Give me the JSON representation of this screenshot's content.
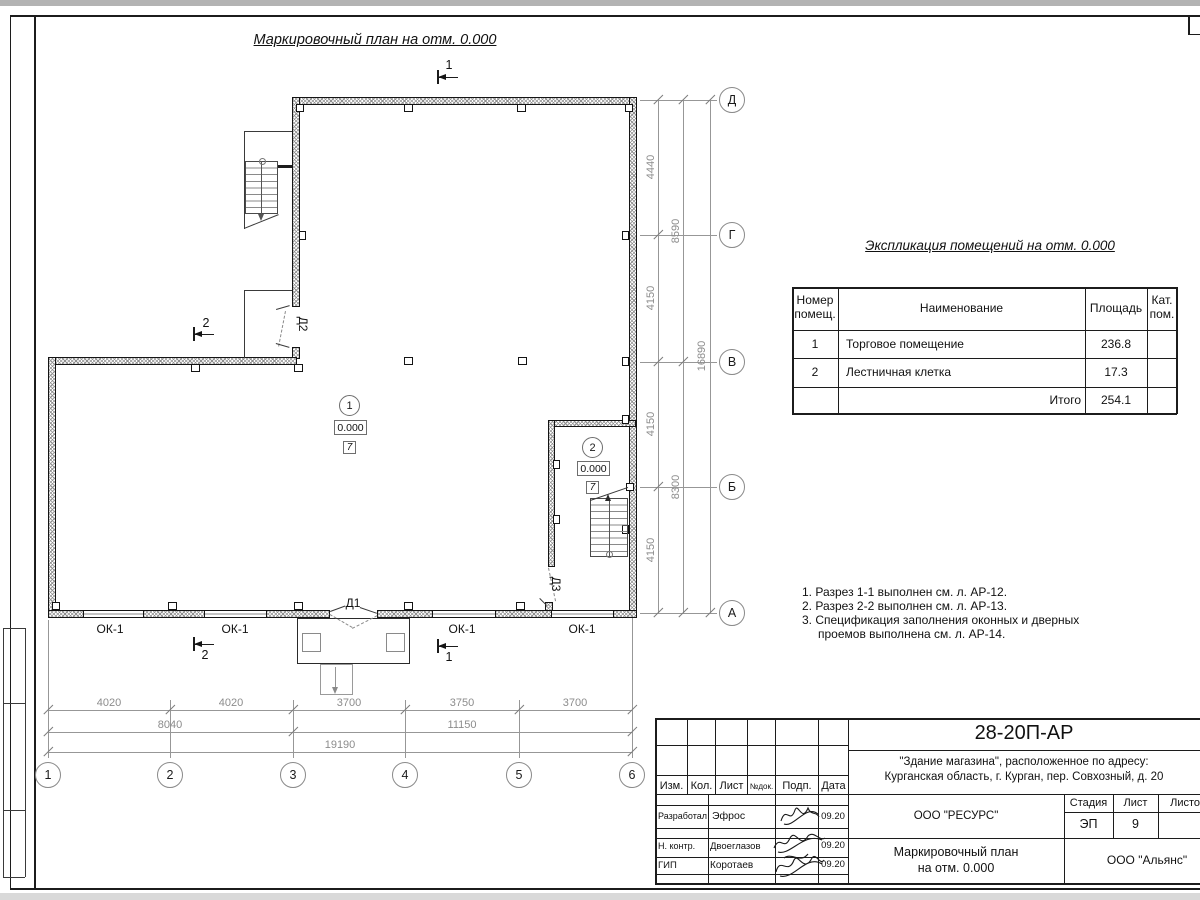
{
  "sheet": {
    "title": "Маркировочный план на отм. 0.000"
  },
  "plan": {
    "rows": [
      "Д",
      "Г",
      "В",
      "Б",
      "А"
    ],
    "cols": [
      "1",
      "2",
      "3",
      "4",
      "5",
      "6"
    ],
    "dim_right_inner": [
      "4440",
      "4150",
      "4150",
      "4150"
    ],
    "dim_right_mid": [
      "8590",
      "8300"
    ],
    "dim_right_outer": "16890",
    "dim_bottom_inner": [
      "4020",
      "4020",
      "3700",
      "3750",
      "3700"
    ],
    "dim_bottom_mid": [
      "8040",
      "11150"
    ],
    "dim_bottom_outer": "19190",
    "window_mark": "ОК-1",
    "doors": {
      "d1": "Д1",
      "d2": "Д2",
      "d3": "Д3"
    },
    "rooms": [
      {
        "num": "1",
        "elev": "0.000",
        "cat": "7"
      },
      {
        "num": "2",
        "elev": "0.000",
        "cat": "7"
      }
    ],
    "section1": "1",
    "section2": "2"
  },
  "explication": {
    "title": "Экспликация помещений на отм. 0.000",
    "col_num": "Номер\nпомещ.",
    "col_name": "Наименование",
    "col_area": "Площадь",
    "col_cat": "Кат.\nпом.",
    "rows": [
      {
        "num": "1",
        "name": "Торговое помещение",
        "area": "236.8"
      },
      {
        "num": "2",
        "name": "Лестничная клетка",
        "area": "17.3"
      }
    ],
    "total_label": "Итого",
    "total_value": "254.1"
  },
  "notes": {
    "n1": "1. Разрез 1-1 выполнен см. л. АР-12.",
    "n2": "2. Разрез 2-2 выполнен см. л. АР-13.",
    "n3": "3. Спецификация заполнения оконных и дверных",
    "n4": "проемов выполнена см. л. АР-14."
  },
  "titleblock": {
    "doc_number": "28-20П-АР",
    "project_line1": "\"Здание магазина\", расположенное по адресу:",
    "project_line2": "Курганская область, г. Курган, пер. Совхозный, д. 20",
    "h_izm": "Изм.",
    "h_kol": "Кол.",
    "h_list": "Лист",
    "h_ndok": "№док.",
    "h_podp": "Подп.",
    "h_data": "Дата",
    "r1_role": "Разработал",
    "r1_name": "Эфрос",
    "r1_date": "09.20",
    "r2_role": "Н. контр.",
    "r2_name": "Двоеглазов",
    "r2_date": "09.20",
    "r3_role": "ГИП",
    "r3_name": "Коротаев",
    "r3_date": "09.20",
    "org1": "ООО \"РЕСУРС\"",
    "stage_label": "Стадия",
    "sheet_label": "Лист",
    "sheets_label": "Листов",
    "stage": "ЭП",
    "sheet_no": "9",
    "title_line1": "Маркировочный план",
    "title_line2": "на отм. 0.000",
    "org2": "ООО \"Альянс\""
  }
}
